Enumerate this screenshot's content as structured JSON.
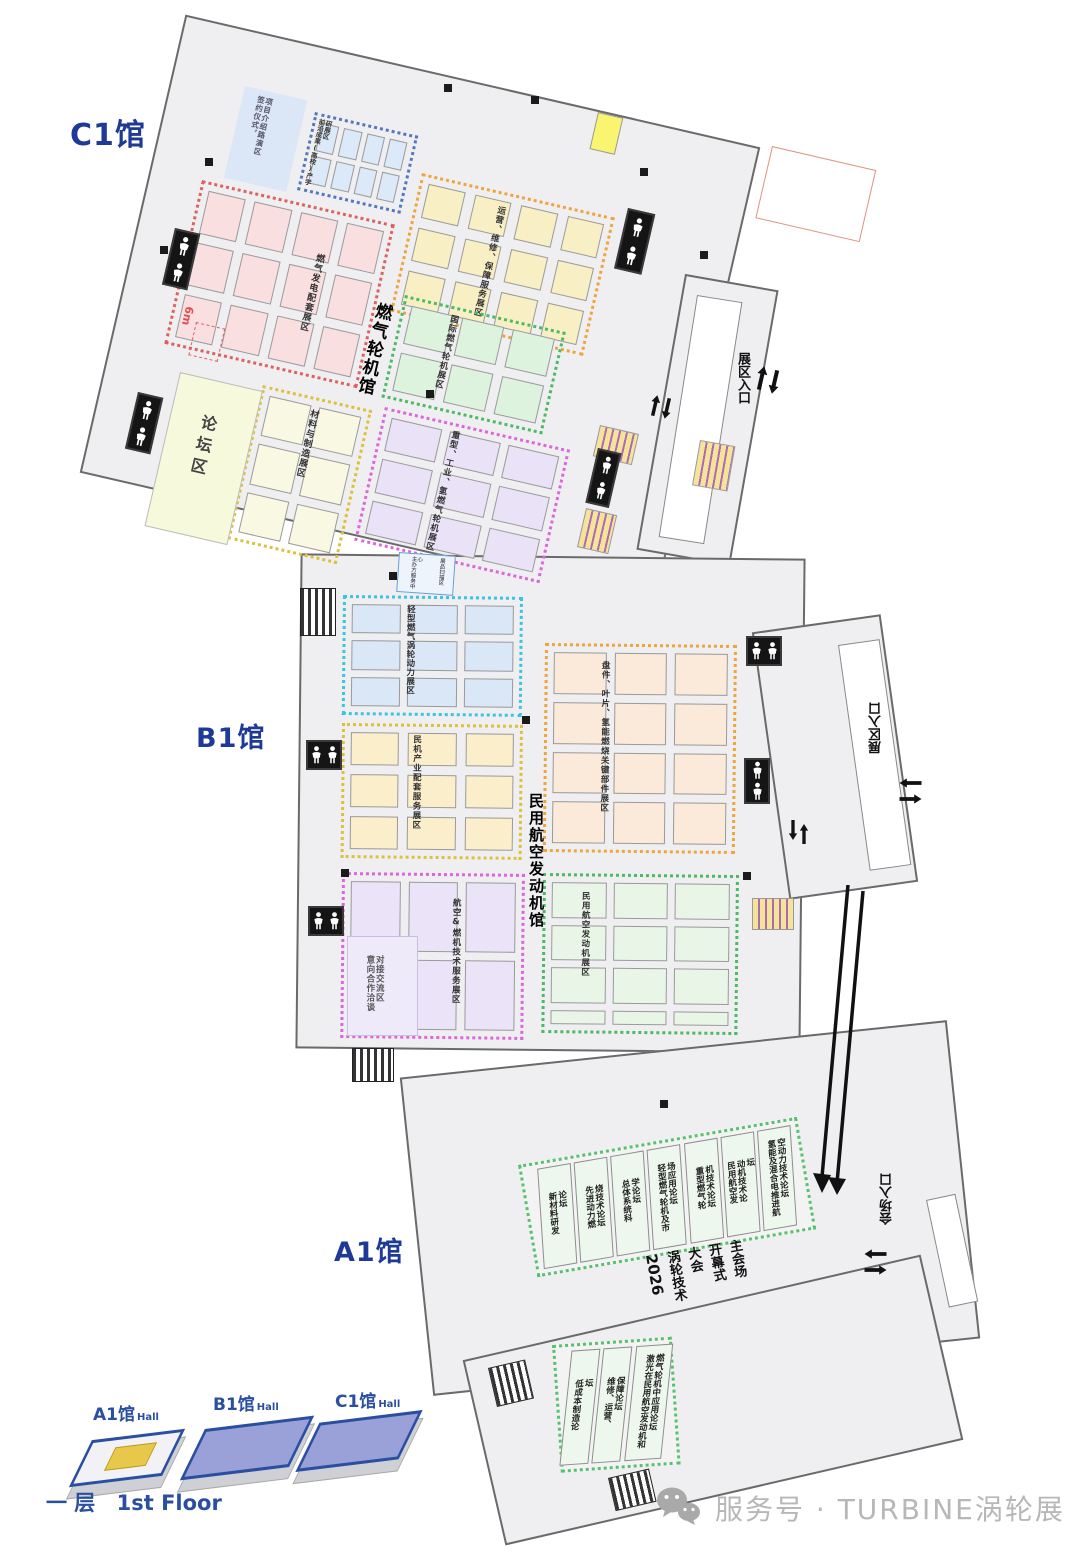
{
  "halls": {
    "c1": {
      "label": "C1馆",
      "name": "燃气轮机馆",
      "forum_area": "论坛区",
      "fire_lane_width": "6m",
      "zones": {
        "signing_line1": "签约仪式，",
        "signing_line2": "项目介绍路演区",
        "frontier": "前沿成果(高校)产学研展区",
        "gas_power": "燃气发电配套展区",
        "ops": "运营、维修、保障服务展区",
        "intl": "国际燃气轮机展区",
        "materials": "材料与制造展区",
        "heavy": "重型、工业、氢燃气轮机展区"
      }
    },
    "b1": {
      "label": "B1馆",
      "name": "民用航空发动机馆",
      "zones": {
        "light_turbine": "轻型燃气涡轮动力展区",
        "civil_support": "民机产业配套服务展区",
        "key_parts": "盘件、叶片、氢能燃烧关键部件展区",
        "aviation_service": "航空&燃机技术服务展区",
        "civil_engine": "民用航空发动机展区",
        "negotiation": "意向合作洽谈对接交流区",
        "service_center_1": "主办方服务中心",
        "service_center_2": "展品扫描区"
      }
    },
    "a1": {
      "label": "A1馆",
      "forums": [
        "新材料研发论坛",
        "先进动力燃烧技术论坛",
        "总体系统科学论坛",
        "轻型燃气轮机及市场应用论坛",
        "重型燃气轮机技术论坛",
        "民用航空发动机技术论坛",
        "氢能及混合电推进航空动力技术论坛"
      ],
      "south_forums": [
        "低成本制造论坛",
        "维修、运营、保障论坛",
        "激光在民用航空发动机和燃气轮机中应用论坛"
      ],
      "conference_lines": [
        "2026",
        "涡轮技术",
        "大会",
        "开幕式",
        "主会场"
      ]
    }
  },
  "entrances": {
    "c1_east": "展区入口",
    "b1_east": "展区入口",
    "a1_south": "会场入口"
  },
  "legend": {
    "a1_name": "A1馆",
    "a1_suffix": "Hall",
    "b1_name": "B1馆",
    "b1_suffix": "Hall",
    "c1_name": "C1馆",
    "c1_suffix": "Hall",
    "floor_cn": "一 层",
    "floor_en": "1st Floor"
  },
  "footer": {
    "account": "服务号 · TURBINE涡轮展"
  },
  "colors": {
    "hall_label": "#1e3a96",
    "zone_red": "#e06060",
    "zone_orange": "#f0a43c",
    "zone_green": "#4bbb63",
    "zone_blue": "#5577c0",
    "zone_cyan": "#38c4e2",
    "zone_magenta": "#dd66dd",
    "zone_yellow": "#ddc13a",
    "footer_gray": "#b7b7b7"
  }
}
